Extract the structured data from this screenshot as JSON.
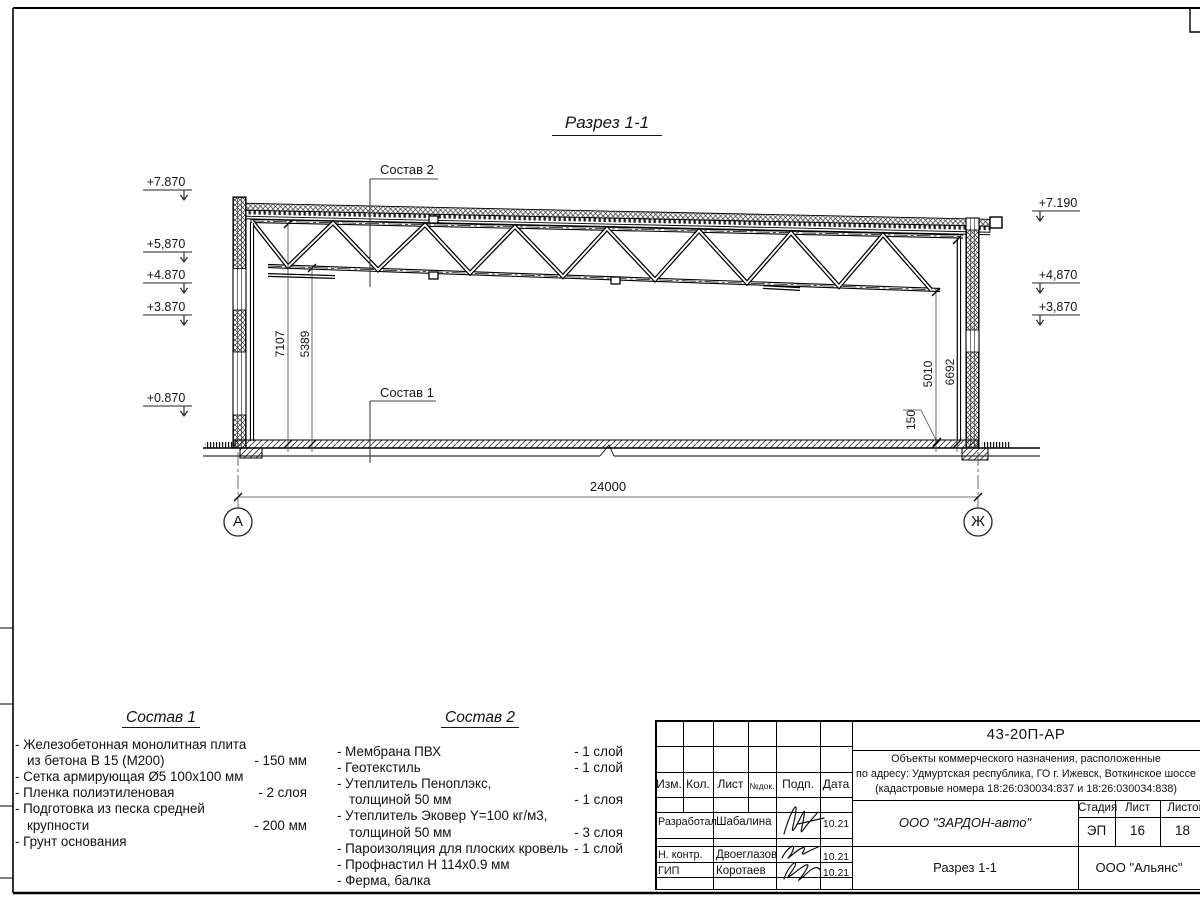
{
  "sheet": {
    "drawing_title": "Разрез 1-1",
    "doc_code": "43-20П-АР"
  },
  "section": {
    "callout_top": "Состав 2",
    "callout_bottom": "Состав 1",
    "elev_left": [
      "+7.870",
      "+5,870",
      "+4.870",
      "+3.870",
      "+0.870"
    ],
    "elev_right": [
      "+7.190",
      "+4,870",
      "+3,870"
    ],
    "dim_left": [
      "7107",
      "5389"
    ],
    "dim_right": [
      "5010",
      "6692"
    ],
    "dim_slab": "150",
    "dim_span": "24000",
    "axis_left": "А",
    "axis_right": "Ж"
  },
  "sostav1": {
    "title": "Состав 1",
    "lines": [
      {
        "t": "- Железобетонная  монолитная плита",
        "v": ""
      },
      {
        "t": "из бетона В 15 (М200)",
        "v": "- 150 мм"
      },
      {
        "t": "- Сетка армирующая Ø5 100х100 мм",
        "v": ""
      },
      {
        "t": "- Пленка полиэтиленовая",
        "v": "-  2 слоя"
      },
      {
        "t": "- Подготовка из песка средней",
        "v": ""
      },
      {
        "t": "крупности",
        "v": "- 200 мм"
      },
      {
        "t": "- Грунт основания",
        "v": ""
      }
    ]
  },
  "sostav2": {
    "title": "Состав 2",
    "lines": [
      {
        "t": "- Мембрана ПВХ",
        "v": "- 1 слой"
      },
      {
        "t": "- Геотекстиль",
        "v": "- 1 слой"
      },
      {
        "t": "- Утеплитель Пеноплэкс,",
        "v": ""
      },
      {
        "t": "толщиной 50 мм",
        "v": "- 1 слоя"
      },
      {
        "t": "- Утеплитель Эковер Y=100 кг/м3,",
        "v": ""
      },
      {
        "t": "толщиной 50 мм",
        "v": "- 3 слоя"
      },
      {
        "t": "- Пароизоляция для плоских кровель",
        "v": "- 1 слой"
      },
      {
        "t": "- Профнастил Н 114х0.9 мм",
        "v": ""
      },
      {
        "t": "- Ферма, балка",
        "v": ""
      }
    ]
  },
  "titleblock": {
    "header_cols": [
      "Изм.",
      "Кол.",
      "Лист",
      "№док.",
      "Подп.",
      "Дата"
    ],
    "project_lines": [
      "Объекты коммерческого назначения, расположенные",
      "по адресу: Удмуртская республика, ГО г. Ижевск, Воткинское шоссе",
      "(кадастровые номера 18:26:030034:837 и 18:26:030034:838)"
    ],
    "rows": [
      {
        "role": "Разработал",
        "name": "Шабалина",
        "date": "10.21"
      },
      {
        "role": "Н. контр.",
        "name": "Двоеглазов",
        "date": "10.21"
      },
      {
        "role": "ГИП",
        "name": "Коротаев",
        "date": "10.21"
      }
    ],
    "company": "ООО \"ЗАРДОН-авто\"",
    "sheet_title": "Разрез 1-1",
    "stage_label": "Стадия",
    "sheet_label": "Лист",
    "sheets_label": "Листов",
    "stage": "ЭП",
    "sheet_no": "16",
    "sheets_total": "18",
    "contractor": "ООО \"Альянс\""
  }
}
